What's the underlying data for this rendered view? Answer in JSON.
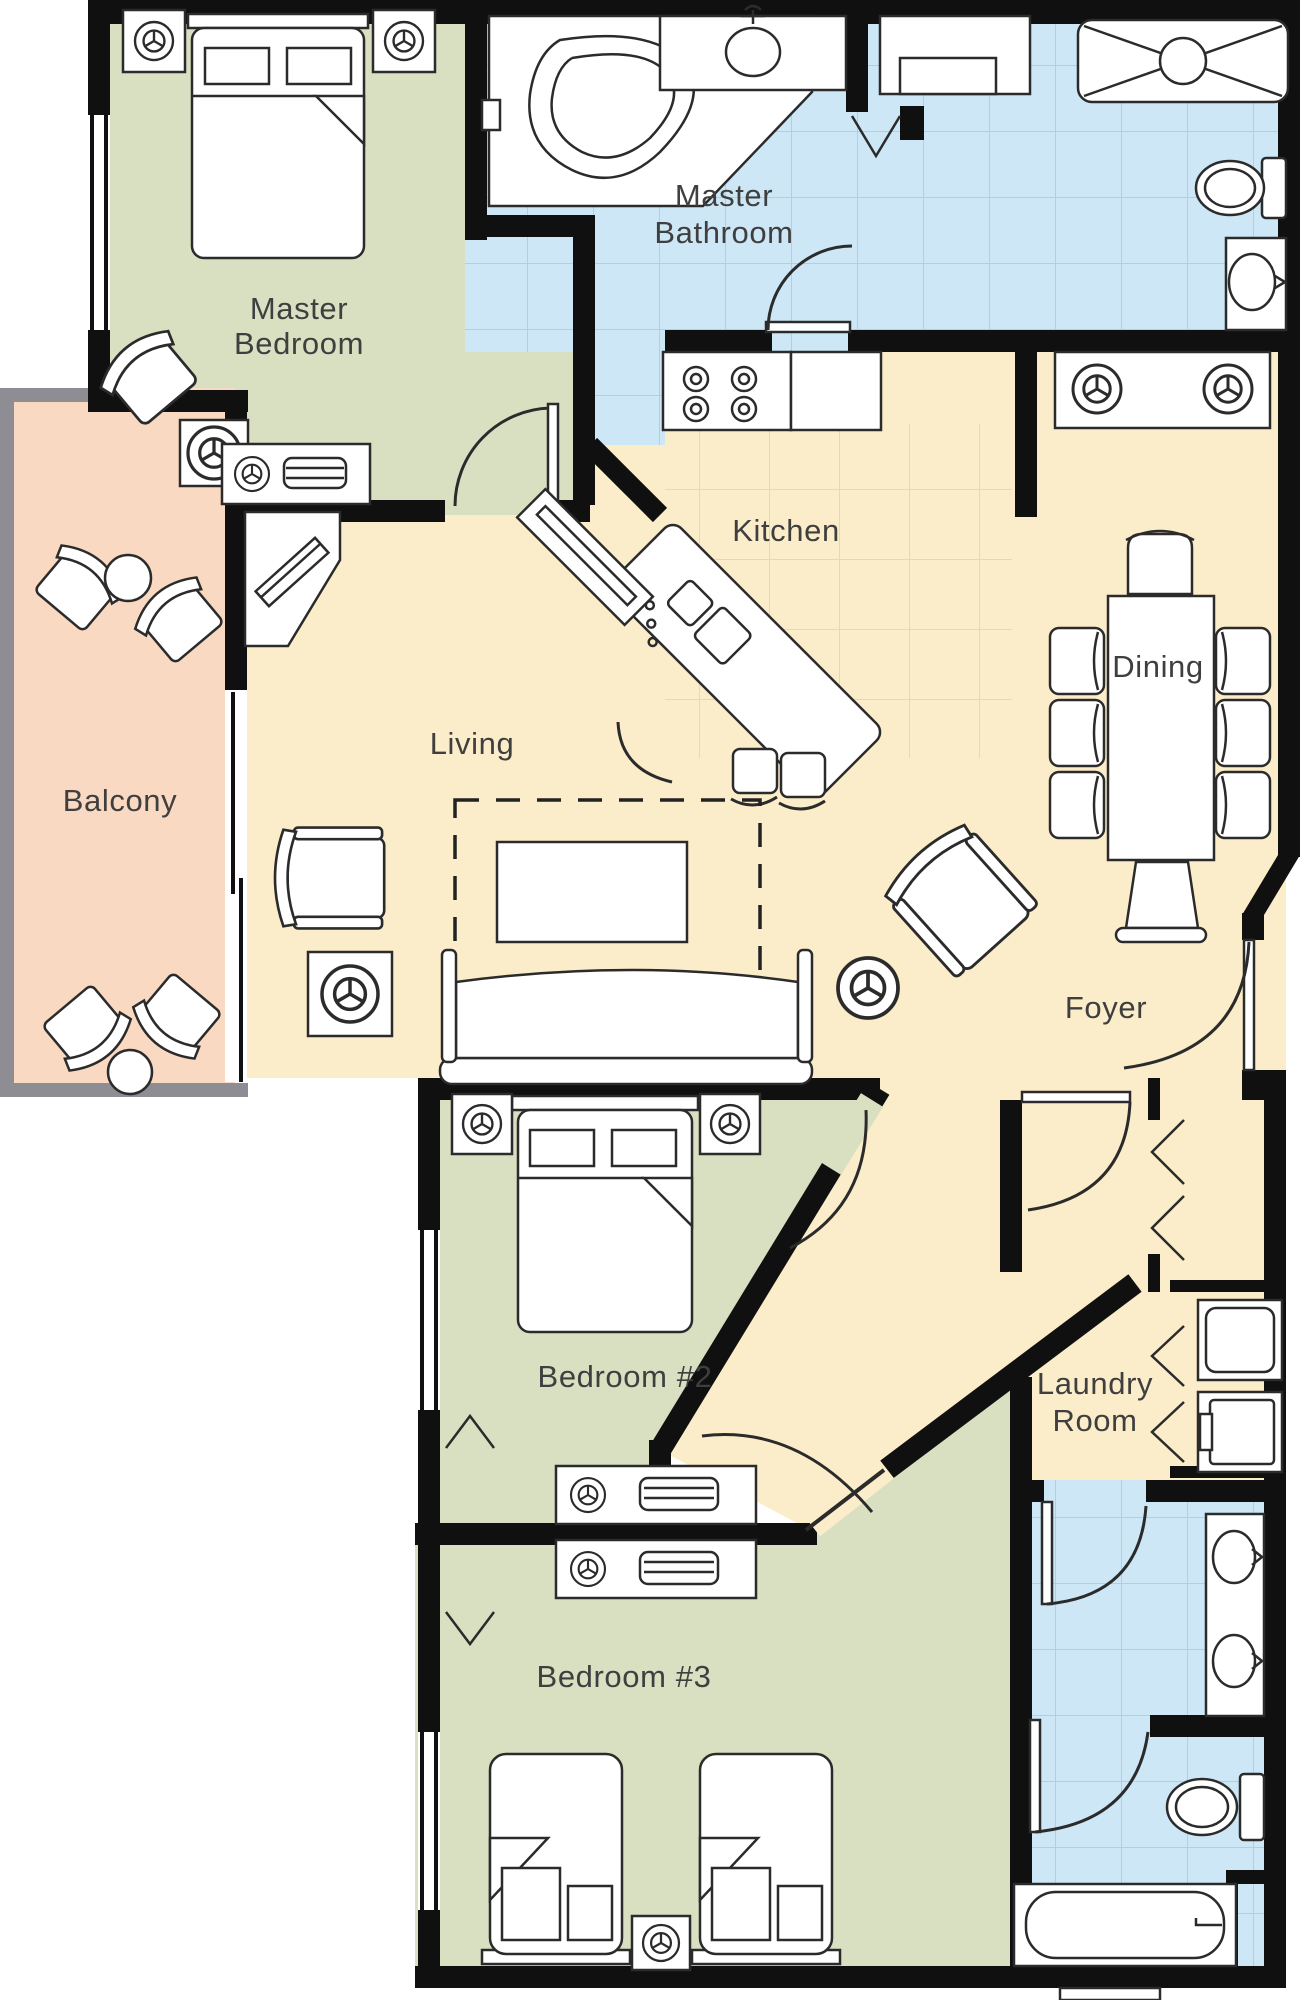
{
  "palette": {
    "wall": "#101010",
    "bedroom_green": "#d9e0c2",
    "bath_blue": "#cde7f6",
    "living_cream": "#fcedca",
    "balcony_salmon": "#f9d9c1",
    "balcony_wall_gray": "#8d8d93",
    "tile_line": "#aecfe5",
    "kitchen_tile_line": "#e7d8af",
    "label": "#3f3f3f",
    "furniture_fill": "#ffffff",
    "furniture_stroke": "#2b2b2b"
  },
  "rooms": {
    "master_bedroom": {
      "line1": "Master",
      "line2": "Bedroom"
    },
    "master_bathroom": {
      "line1": "Master",
      "line2": "Bathroom"
    },
    "kitchen": {
      "label": "Kitchen"
    },
    "dining": {
      "label": "Dining"
    },
    "living": {
      "label": "Living"
    },
    "balcony": {
      "label": "Balcony"
    },
    "foyer": {
      "label": "Foyer"
    },
    "bedroom2": {
      "label": "Bedroom #2"
    },
    "laundry": {
      "line1": "Laundry",
      "line2": "Room"
    },
    "bedroom3": {
      "label": "Bedroom #3"
    }
  }
}
